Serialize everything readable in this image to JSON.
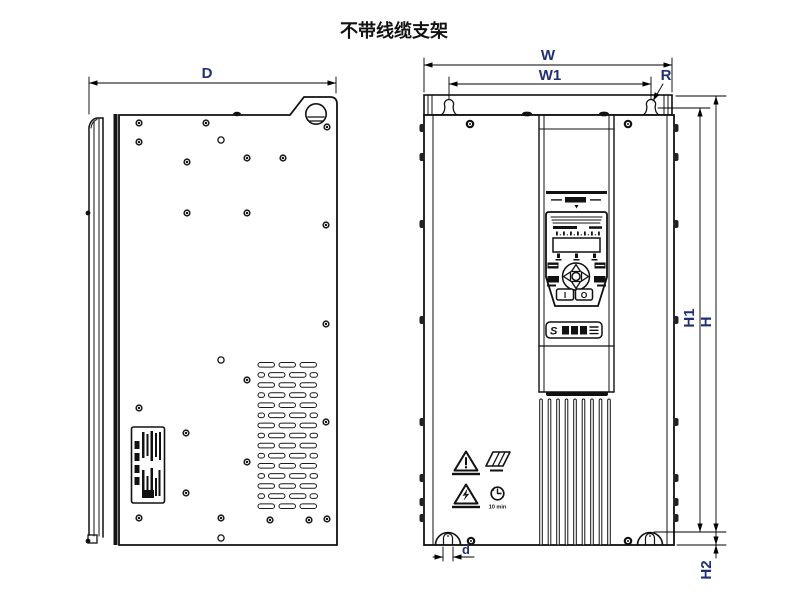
{
  "title": "不带线缆支架",
  "colors": {
    "line": "#000000",
    "dim_label": "#203070",
    "background": "#ffffff"
  },
  "views": {
    "side": {
      "dim_depth": "D"
    },
    "front": {
      "dim_width": "W",
      "dim_mount_width": "W1",
      "dim_slot_radius": "R",
      "dim_height": "H",
      "dim_mount_height": "H1",
      "dim_bottom_offset": "H2",
      "dim_slot_width": "d",
      "keypad": {
        "run_button": "I",
        "stop_button": "O"
      },
      "brand_badge": {
        "logo_glyph": "S"
      },
      "warnings": {
        "wait_label": "10 min"
      }
    }
  }
}
